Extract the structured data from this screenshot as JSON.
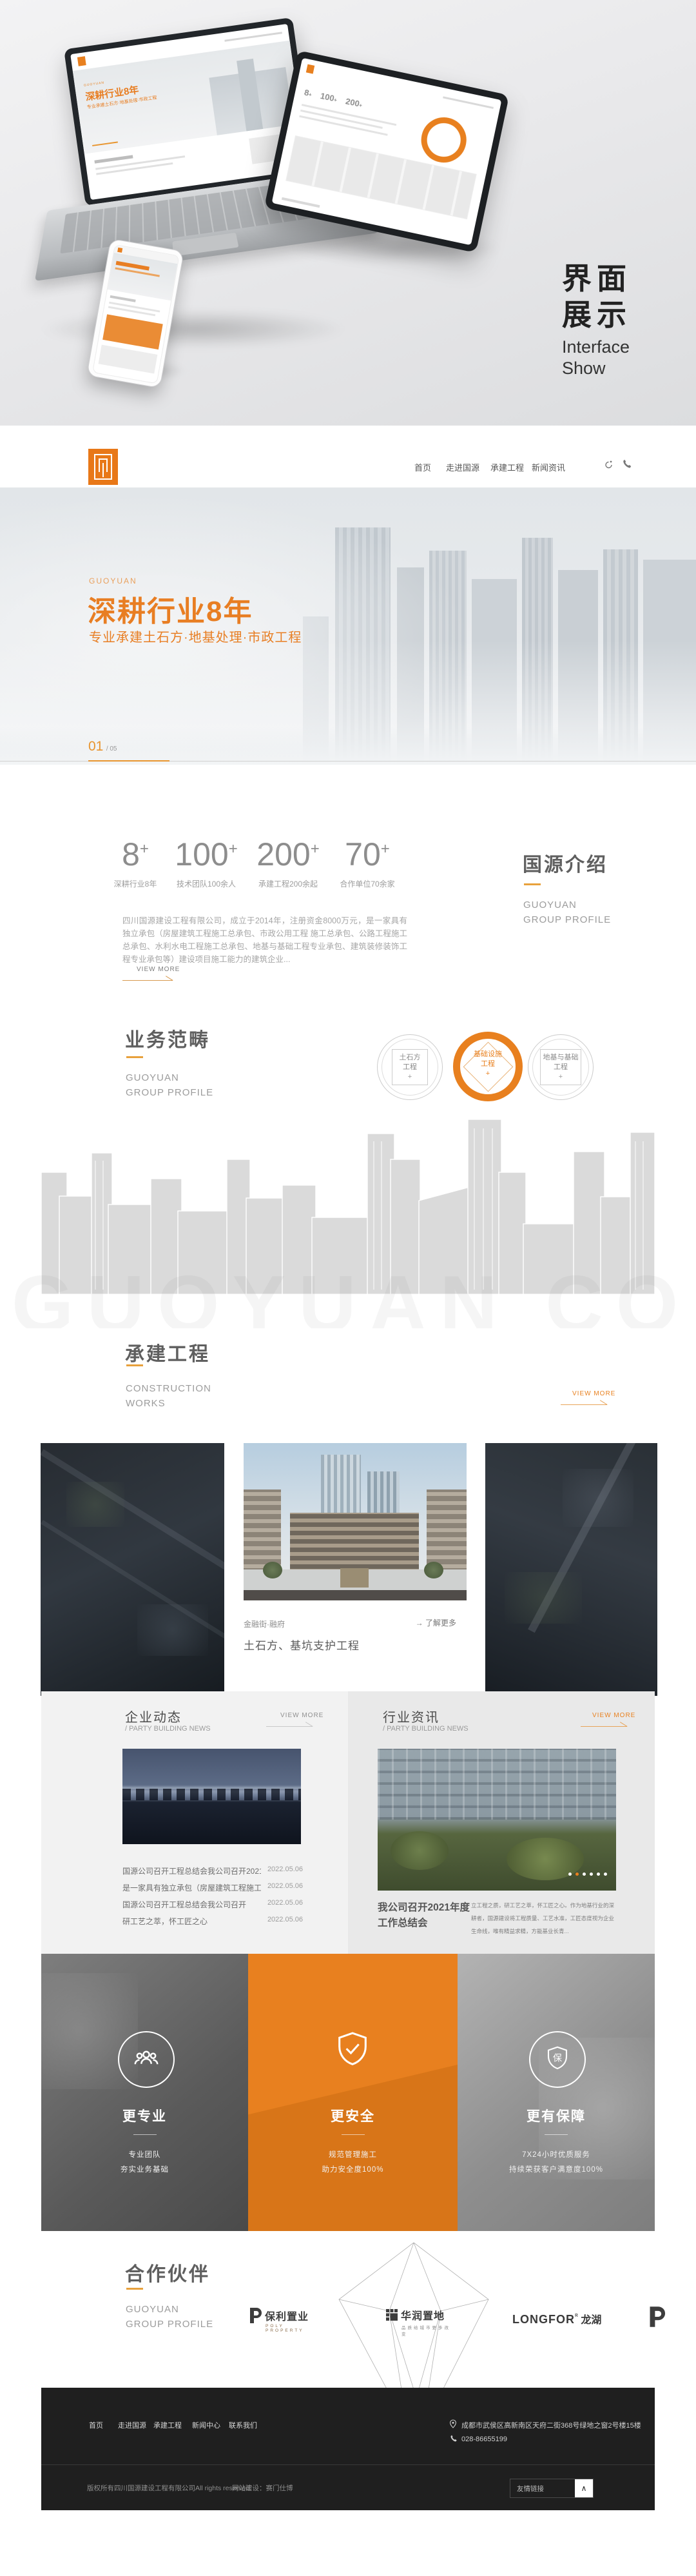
{
  "colors": {
    "accent": "#E8801F",
    "accent_light": "#E8A13C",
    "footer_bg": "#1F1F1F"
  },
  "showcase": {
    "title_line1": "界面",
    "title_line2": "展示",
    "subtitle_line1": "Interface",
    "subtitle_line2": "Show"
  },
  "header": {
    "nav": [
      {
        "label": "首页"
      },
      {
        "label": "走进国源"
      },
      {
        "label": "承建工程"
      },
      {
        "label": "新闻资讯"
      }
    ]
  },
  "hero": {
    "eyebrow": "GUOYUAN",
    "title": "深耕行业8年",
    "subtitle": "专业承建土石方·地基处理·市政工程",
    "page_current": "01",
    "page_total": "/ 05"
  },
  "intro": {
    "stats": [
      {
        "value": "8",
        "suffix": "+",
        "label": "深耕行业8年"
      },
      {
        "value": "100",
        "suffix": "+",
        "label": "技术团队100余人"
      },
      {
        "value": "200",
        "suffix": "+",
        "label": "承建工程200余起"
      },
      {
        "value": "70",
        "suffix": "+",
        "label": "合作单位70余家"
      }
    ],
    "title": "国源介绍",
    "subtitle_line1": "GUOYUAN",
    "subtitle_line2": "GROUP PROFILE",
    "paragraph": "四川国源建设工程有限公司，成立于2014年，注册资金8000万元，是一家具有独立承包（房屋建筑工程施工总承包、市政公用工程 施工总承包、公路工程施工总承包、水利水电工程施工总承包、地基与基础工程专业承包、建筑装修装饰工程专业承包等）建设项目施工能力的建筑企业...",
    "view_more": "VIEW MORE"
  },
  "business": {
    "title": "业务范畴",
    "subtitle_line1": "GUOYUAN",
    "subtitle_line2": "GROUP PROFILE",
    "items": [
      {
        "line1": "土石方",
        "line2": "工程",
        "plus": "+"
      },
      {
        "line1": "基础设施",
        "line2": "工程",
        "plus": "+"
      },
      {
        "line1": "地基与基础",
        "line2": "工程",
        "plus": "+"
      }
    ],
    "watermark": "GUOYUAN CONS"
  },
  "projects": {
    "title": "承建工程",
    "subtitle_line1": "CONSTRUCTION",
    "subtitle_line2": "WORKS",
    "view_more": "VIEW MORE",
    "featured": {
      "name": "金融街·融府",
      "more_arrow": "→",
      "more_label": "了解更多",
      "desc": "土石方、基坑支护工程"
    }
  },
  "news": {
    "left": {
      "title": "企业动态",
      "subtitle": "/ PARTY BUILDING NEWS",
      "view_more": "VIEW MORE",
      "items": [
        {
          "title": "国源公司召开工程总结会我公司召开2021年",
          "date": "2022.05.06"
        },
        {
          "title": "是一家具有独立承包（房屋建筑工程施工总承包",
          "date": "2022.05.06"
        },
        {
          "title": "国源公司召开工程总结会我公司召开",
          "date": "2022.05.06"
        },
        {
          "title": "研工艺之萃，怀工匠之心",
          "date": "2022.05.06"
        }
      ]
    },
    "right": {
      "title": "行业资讯",
      "subtitle": "/ PARTY BUILDING NEWS",
      "view_more": "VIEW MORE",
      "article_title_line1": "我公司召开2021年度",
      "article_title_line2": "工作总结会",
      "article_desc": "立工程之质，研工艺之萃，怀工匠之心。作为地基行业的深耕者，国源建设将工程质量、工艺水准，工匠态度视为企业生命线，唯有精益求精，方能基业长青..."
    }
  },
  "features": [
    {
      "title": "更专业",
      "line1": "专业团队",
      "line2": "夯实业务基础"
    },
    {
      "title": "更安全",
      "line1": "规范管理施工",
      "line2": "助力安全度100%"
    },
    {
      "title": "更有保障",
      "line1": "7X24小时优质服务",
      "line2": "持续荣获客户满意度100%"
    }
  ],
  "partners": {
    "title": "合作伙伴",
    "subtitle_line1": "GUOYUAN",
    "subtitle_line2": "GROUP PROFILE",
    "logos": [
      {
        "name": "保利置业",
        "sub": "POLY PROPERTY"
      },
      {
        "name": "华润置地",
        "sub": "品质给城市更多改变"
      },
      {
        "name": "LONGFOR",
        "sub": "龙湖"
      }
    ]
  },
  "footer": {
    "nav": [
      {
        "label": "首页"
      },
      {
        "label": "走进国源"
      },
      {
        "label": "承建工程"
      },
      {
        "label": "新闻中心"
      },
      {
        "label": "联系我们"
      }
    ],
    "address": "成都市武侯区高新南区天府二街368号绿地之窗2号楼15楼",
    "phone": "028-86655199",
    "copyright": "版权所有四川国源建设工程有限公司All rights reserved.",
    "built_by": "网站建设：赛门仕博",
    "links_label": "友情链接",
    "collapse_glyph": "∧"
  }
}
